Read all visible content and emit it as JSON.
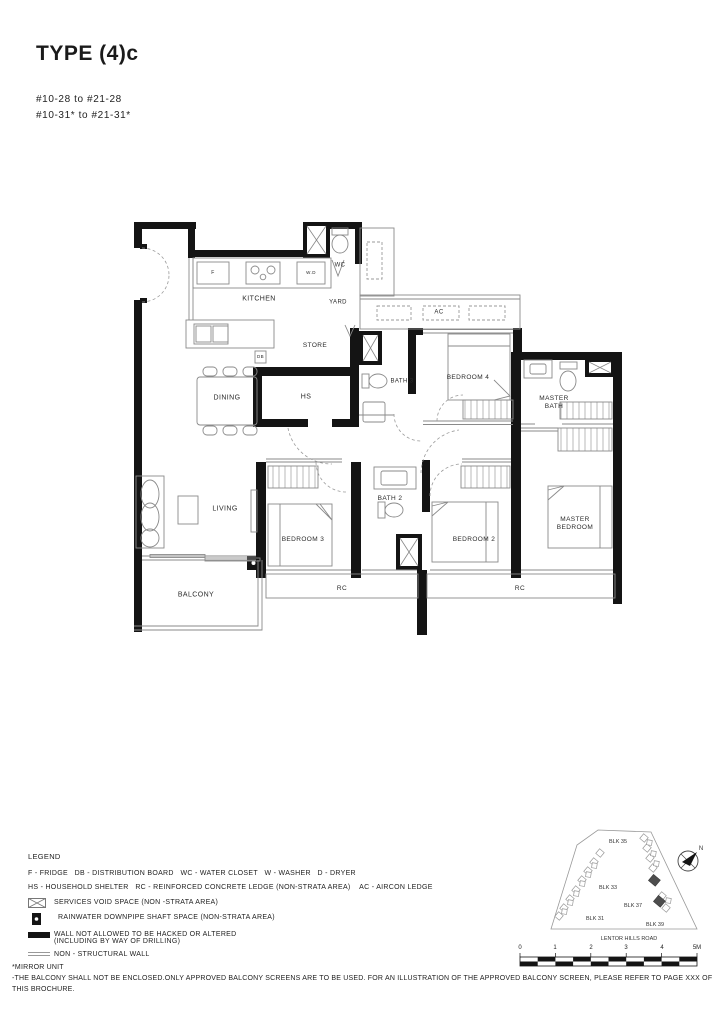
{
  "header": {
    "title": "TYPE (4)c",
    "unit_range_1": "#10-28 to #21-28",
    "unit_range_2": "#10-31* to #21-31*"
  },
  "plan": {
    "rooms": {
      "kitchen": "KITCHEN",
      "yard": "YARD",
      "wc": "WC",
      "store": "STORE",
      "hs": "HS",
      "dining": "DINING",
      "bath3": "BATH 3",
      "bedroom4": "BEDROOM 4",
      "master_bath": "MASTER BATH",
      "living": "LIVING",
      "bedroom3": "BEDROOM 3",
      "bath2": "BATH 2",
      "bedroom2": "BEDROOM 2",
      "master_bedroom": "MASTER BEDROOM",
      "balcony": "BALCONY"
    },
    "annotations": {
      "fridge": "F",
      "washer_dryer": "W.D",
      "distribution_board": "DB",
      "aircon": "AC",
      "rc_left": "RC",
      "rc_right": "RC"
    }
  },
  "legend": {
    "heading": "LEGEND",
    "abbreviations_line_1": "F - FRIDGE   DB - DISTRIBUTION BOARD   WC - WATER CLOSET   W - WASHER   D - DRYER",
    "abbreviations_line_2": "HS - HOUSEHOLD SHELTER   RC - REINFORCED CONCRETE LEDGE (NON-STRATA AREA)    AC - AIRCON LEDGE",
    "services_void": "SERVICES VOID SPACE (NON -STRATA AREA)",
    "rainwater": "RAINWATER DOWNPIPE SHAFT SPACE (NON-STRATA AREA)",
    "wall_line_1": "WALL NOT ALLOWED TO BE HACKED OR ALTERED",
    "wall_line_2": "(INCLUDING BY WAY OF DRILLING)",
    "non_structural": "NON - STRUCTURAL WALL"
  },
  "site_plan": {
    "blocks": {
      "blk35": "BLK 35",
      "blk33": "BLK 33",
      "blk37": "BLK 37",
      "blk31": "BLK 31",
      "blk39": "BLK 39"
    },
    "road": "LENTOR HILLS ROAD",
    "north": "N",
    "scale": {
      "s0": "0",
      "s1": "1",
      "s2": "2",
      "s3": "3",
      "s4": "4",
      "s5": "5M"
    }
  },
  "footnotes": {
    "mirror": "*MIRROR UNIT",
    "balcony_note": "-THE BALCONY SHALL NOT BE ENCLOSED.ONLY APPROVED BALCONY SCREENS ARE TO BE USED. FOR AN ILLUSTRATION OF THE APPROVED BALCONY SCREEN, PLEASE REFER TO PAGE XXX OF THIS BROCHURE."
  }
}
